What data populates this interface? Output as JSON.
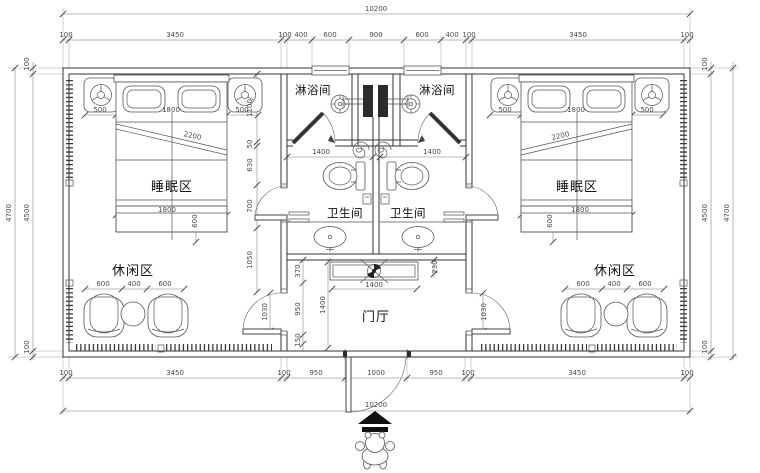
{
  "labels": {
    "sleep_left": "睡眠区",
    "sleep_right": "睡眠区",
    "shower_left": "淋浴间",
    "shower_right": "淋浴间",
    "wc_left": "卫生间",
    "wc_right": "卫生间",
    "leisure_left": "休闲区",
    "leisure_right": "休闲区",
    "hall": "门厅"
  },
  "dims": {
    "total": "10200",
    "top": [
      "100",
      "3450",
      "100",
      "400",
      "600",
      "900",
      "600",
      "400",
      "100",
      "3450",
      "100"
    ],
    "bottom": [
      "100",
      "3450",
      "100",
      "950",
      "1000",
      "950",
      "100",
      "3450",
      "100"
    ],
    "left": {
      "outer": "4700",
      "inner": "4500",
      "wall_top": "100",
      "wall_bottom": "100"
    },
    "right": {
      "inner": "4500",
      "outer": "4700",
      "wall_top": "100",
      "wall_bottom": "100"
    },
    "bed": [
      "500",
      "1800",
      "500"
    ],
    "bed_len": "2200",
    "bed_foot_w": "1800",
    "bed_foot_h": "600",
    "leisure": [
      "600",
      "400",
      "600"
    ],
    "shower_w": "1400",
    "hall_w": "1400",
    "hall_d": "1400",
    "hall_left": [
      "370",
      "950",
      "150"
    ],
    "hall_right": "230",
    "mid_chain": [
      "1100",
      "50",
      "630",
      "700",
      "1050"
    ],
    "door": "1030"
  },
  "colors": {
    "line": "#333",
    "dim": "#4a4a4a",
    "paper": "#ffffff",
    "accent": "#2b2b2b"
  }
}
